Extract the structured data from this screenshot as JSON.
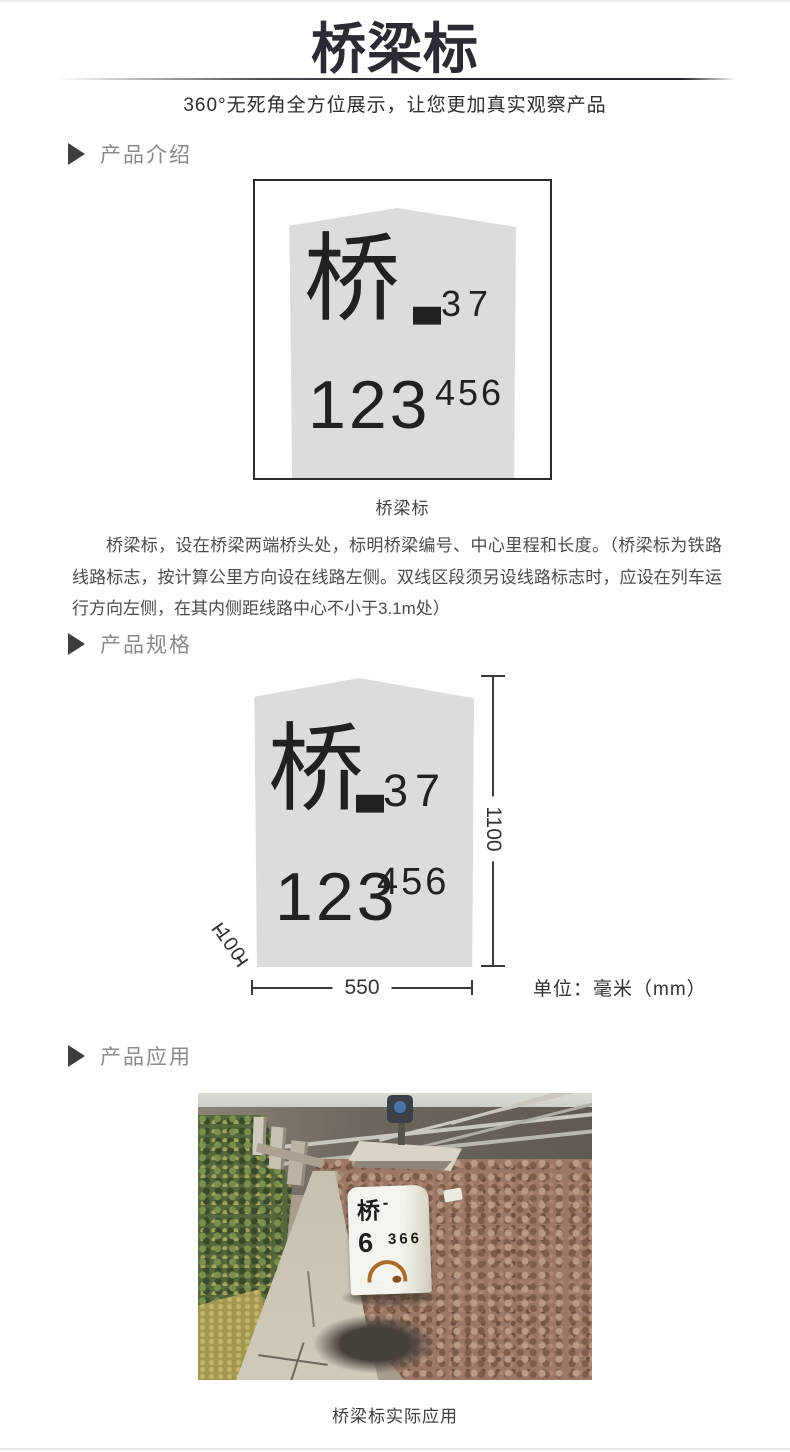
{
  "header": {
    "title": "桥梁标",
    "subtitle": "360°无死角全方位展示，让您更加真实观察产品"
  },
  "sections": {
    "intro_label": "产品介绍",
    "spec_label": "产品规格",
    "app_label": "产品应用"
  },
  "marker_sign": {
    "char": "桥",
    "dash": "—",
    "serial": "37",
    "mileage_main": "123",
    "mileage_sub": "456"
  },
  "intro": {
    "caption": "桥梁标",
    "description": "桥梁标，设在桥梁两端桥头处，标明桥梁编号、中心里程和长度。（桥梁标为铁路线路标志，按计算公里方向设在线路左侧。双线区段须另设线路标志时，应设在列车运行方向左侧，在其内侧距线路中心不小于3.1m处）"
  },
  "spec": {
    "height_mm": "1100",
    "width_mm": "550",
    "depth_mm": "100",
    "unit": "单位：毫米（mm）"
  },
  "application": {
    "caption": "桥梁标实际应用",
    "stone_char": "桥",
    "stone_dash": "-",
    "stone_number": "6",
    "stone_number_sub": "366"
  },
  "colors": {
    "title": "#2b2b33",
    "section_label": "#8a8a8a",
    "marker_fill": "#dcdcda",
    "marker_text": "#21211f",
    "dimension_line": "#3a3a3a",
    "photo_ballast": "#9a7766",
    "photo_vegetation": "#57673c"
  }
}
